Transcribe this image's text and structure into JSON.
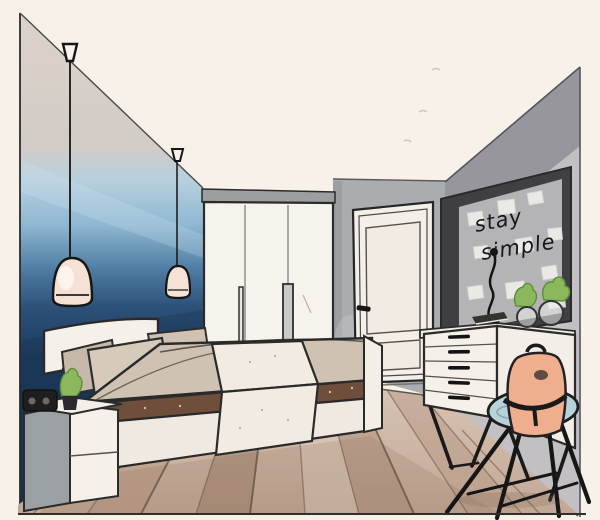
{
  "scene": {
    "title": "Hand-drawn bedroom interior sketch",
    "style": "watercolor and ink, one-point perspective",
    "objects": [
      "ombre blue accent wall",
      "two pendant lamps on long black cords",
      "bed with white headboard, beige pillows, beige duvet and cream runner",
      "white two-drawer nightstand with black speaker and small plant",
      "white three-door wardrobe with grey top strip",
      "white paneled door in grey wall",
      "grey memo board with pinned notes",
      "black desk lamp on dresser",
      "white five-drawer dresser with book and glass plant vases",
      "round blue stool with peach backpack",
      "wooden plank floor fanning toward viewer"
    ]
  },
  "board": {
    "line1": "stay",
    "line2": "simple"
  },
  "palette": {
    "paper": "#f7f1ea",
    "outline": "#2b2b2b",
    "wall_beige": "#d9cfc8",
    "wall_light_blue": "#a9cadf",
    "wall_mid_blue": "#4f7da3",
    "wall_navy": "#1c3a5e",
    "wardrobe_white": "#f6f2ec",
    "wardrobe_top_gray": "#9b9fa2",
    "door_wall_gray": "#a9adb0",
    "door_white": "#f4efe8",
    "right_wall_dark": "#97969c",
    "right_wall_light": "#c2c0c2",
    "board_frame": "#3f4043",
    "board_interior": "#b4b3b6",
    "note_white": "#f0eeea",
    "text_ink": "#15191b",
    "dresser_white": "#f5f1ea",
    "chair_seat_blue": "#b7d2da",
    "backpack_peach": "#efae8e",
    "bed_headboard": "#f5f1ea",
    "pillow_beige": "#d6cabb",
    "duvet_beige": "#cfc2b2",
    "runner_cream": "#f1ebe1",
    "bed_stripe_brown": "#6f4e3c",
    "bed_base_white": "#efe9e1",
    "nightstand_gray": "#9aa0a3",
    "floor_base": "#c9b2a1",
    "plank_dark": "#6a564a",
    "plant_green": "#8bb85a",
    "lamp_shade": "#f6e2d4",
    "black_detail": "#1a1a1a"
  }
}
